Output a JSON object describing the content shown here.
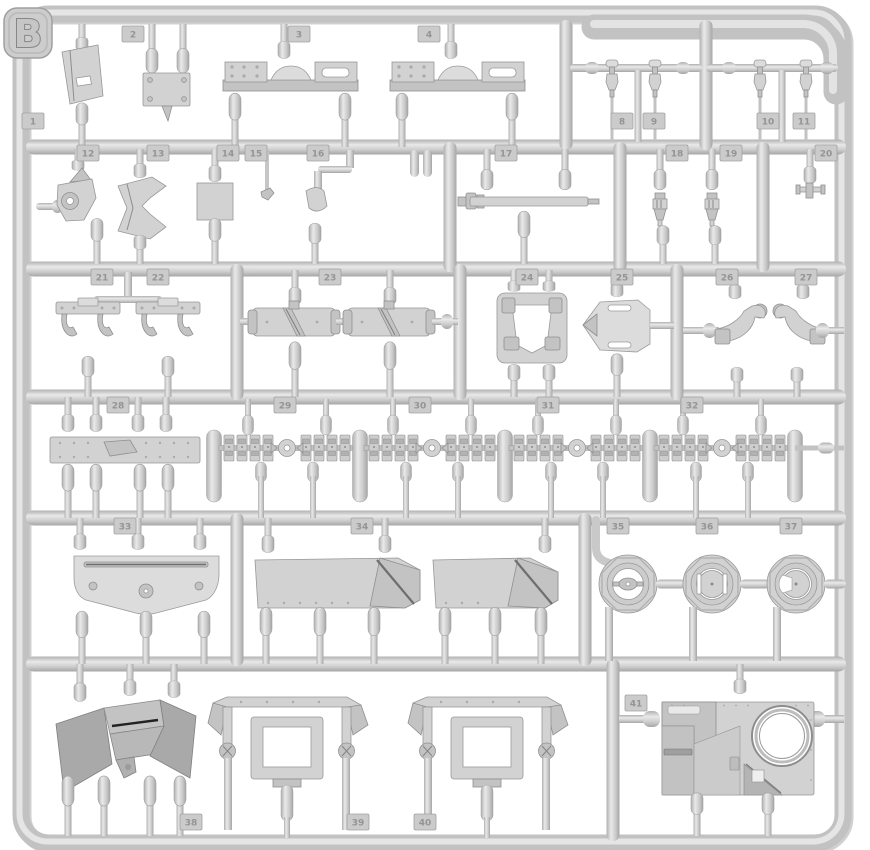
{
  "title": "Plastic model kit sprue — frame B",
  "sprue": {
    "letter": "B"
  },
  "colors": {
    "plastic": "#cdcdcd",
    "highlight": "#e8e8e8",
    "shadow": "#a6a6a6",
    "background": "#ffffff",
    "tab_text": "#949494",
    "slot_dark": "#2a2a2a"
  },
  "tabs": [
    {
      "label": "1",
      "x": 33,
      "y": 121
    },
    {
      "label": "2",
      "x": 133,
      "y": 34
    },
    {
      "label": "3",
      "x": 299,
      "y": 34
    },
    {
      "label": "4",
      "x": 429,
      "y": 34
    },
    {
      "label": "8",
      "x": 622,
      "y": 121
    },
    {
      "label": "9",
      "x": 654,
      "y": 121
    },
    {
      "label": "10",
      "x": 768,
      "y": 121
    },
    {
      "label": "11",
      "x": 804,
      "y": 121
    },
    {
      "label": "12",
      "x": 88,
      "y": 153
    },
    {
      "label": "13",
      "x": 158,
      "y": 153
    },
    {
      "label": "14",
      "x": 228,
      "y": 153
    },
    {
      "label": "15",
      "x": 256,
      "y": 153
    },
    {
      "label": "16",
      "x": 318,
      "y": 153
    },
    {
      "label": "17",
      "x": 506,
      "y": 153
    },
    {
      "label": "18",
      "x": 677,
      "y": 153
    },
    {
      "label": "19",
      "x": 731,
      "y": 153
    },
    {
      "label": "20",
      "x": 826,
      "y": 153
    },
    {
      "label": "21",
      "x": 102,
      "y": 277
    },
    {
      "label": "22",
      "x": 158,
      "y": 277
    },
    {
      "label": "23",
      "x": 330,
      "y": 277
    },
    {
      "label": "24",
      "x": 527,
      "y": 277
    },
    {
      "label": "25",
      "x": 622,
      "y": 277
    },
    {
      "label": "26",
      "x": 727,
      "y": 277
    },
    {
      "label": "27",
      "x": 806,
      "y": 277
    },
    {
      "label": "28",
      "x": 118,
      "y": 405
    },
    {
      "label": "29",
      "x": 285,
      "y": 405
    },
    {
      "label": "30",
      "x": 420,
      "y": 405
    },
    {
      "label": "31",
      "x": 548,
      "y": 405
    },
    {
      "label": "32",
      "x": 692,
      "y": 405
    },
    {
      "label": "33",
      "x": 125,
      "y": 526
    },
    {
      "label": "34",
      "x": 362,
      "y": 526
    },
    {
      "label": "35",
      "x": 618,
      "y": 526
    },
    {
      "label": "36",
      "x": 707,
      "y": 526
    },
    {
      "label": "37",
      "x": 791,
      "y": 526
    },
    {
      "label": "41",
      "x": 636,
      "y": 703
    },
    {
      "label": "38",
      "x": 191,
      "y": 822
    },
    {
      "label": "39",
      "x": 358,
      "y": 822
    },
    {
      "label": "40",
      "x": 425,
      "y": 822
    }
  ],
  "parts": [
    "angled-bracket-plate",
    "bolted-mounting-box",
    "engine-mount-beam x2",
    "lifting-hook-pin x4",
    "funnel-bracket-with-ring",
    "angle-clamp-bracket",
    "square-plate",
    "small-clip",
    "rounded-lever",
    "gun-barrel-rod",
    "periscope x2",
    "t-fitting",
    "hinge-bracket x2",
    "muffler-cylinder x2",
    "seat-frame",
    "hex-access-plate",
    "crane-bracket x2 mirrored",
    "riveted-fender-strip",
    "track-link-run x4",
    "hull-glacis-plate",
    "angled-fender-panel x2",
    "round-hatch x3",
    "gun-shield",
    "wheel-arch-frame x2",
    "turret-roof-panel-with-hatch-ring"
  ]
}
